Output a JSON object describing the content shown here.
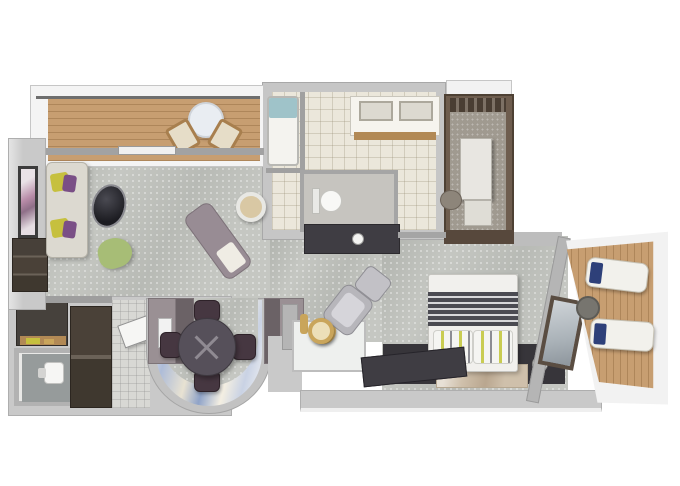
{
  "image": {
    "type": "3d-floor-plan",
    "description": "Top-down 3D rendered floor plan of a cruise-ship style suite: forward balcony with bistro set, living room, dining nook in a curved bay, wet bar, full bathroom with tub, double vanity and separate WC, walk-in closet, guest WC and entry, king bedroom, and an aft balcony with two loungers",
    "background": "#ffffff"
  },
  "palette": {
    "wall_light": "#c9c9c9",
    "wall_white": "#f2f2f2",
    "carpet": "#c5c7c2",
    "deck_wood": "#c79e71",
    "tile_cream": "#ebe7db",
    "corridor_tile": "#d8d8d4",
    "closet_brown": "#6e5d4e",
    "closet_brown_dark": "#57483c",
    "dark_wood": "#46413c",
    "charcoal": "#3f3d43",
    "band_dark": "#37353a",
    "sofa_fabric": "#dcd9d0",
    "pillow_yellow": "#c6c03e",
    "pillow_purple": "#7a4f86",
    "pouf_green": "#a7bd76",
    "chaise_mauve": "#988c94",
    "gold_accent": "#c9a55b",
    "desk_wood": "#b28955",
    "bed_white": "#f1f0ed",
    "rug_tan": "#cfc0ab",
    "pillow_navy": "#2e4079",
    "glass_teal": "#9fc3c9",
    "dining_table": "#56505a",
    "dining_chair": "#463741",
    "armchair_gray": "#b7b6bb",
    "ottoman_taupe": "#8d857a"
  },
  "rooms": [
    {
      "name": "forward-balcony",
      "furniture": [
        "bistro-table",
        "deck-chair",
        "deck-chair"
      ]
    },
    {
      "name": "living-room",
      "furniture": [
        "sofa-with-pillows",
        "framed-art",
        "media-console",
        "egg-chair",
        "green-pouf",
        "chaise-lounge",
        "round-side-table"
      ]
    },
    {
      "name": "dining-nook",
      "furniture": [
        "round-dining-table",
        "dining-chair",
        "dining-chair",
        "dining-chair",
        "dining-chair",
        "curved-mural-window"
      ]
    },
    {
      "name": "wet-bar",
      "furniture": [
        "counter",
        "gold-lamp",
        "bottle"
      ]
    },
    {
      "name": "bathroom",
      "furniture": [
        "bathtub",
        "double-vanity",
        "toilet",
        "console"
      ]
    },
    {
      "name": "walk-in-closet",
      "furniture": [
        "shelving-tower",
        "storage-box",
        "ottoman"
      ]
    },
    {
      "name": "entry",
      "furniture": [
        "desk",
        "guest-wc-toilet",
        "wardrobe",
        "entry-door"
      ]
    },
    {
      "name": "bedroom",
      "furniture": [
        "king-bed",
        "nightstand-lamp",
        "nightstand-lamp",
        "rug",
        "tv-console",
        "armchair",
        "ottoman",
        "gold-side-table",
        "mirror"
      ]
    },
    {
      "name": "aft-balcony",
      "furniture": [
        "lounger",
        "lounger",
        "round-table"
      ]
    }
  ]
}
